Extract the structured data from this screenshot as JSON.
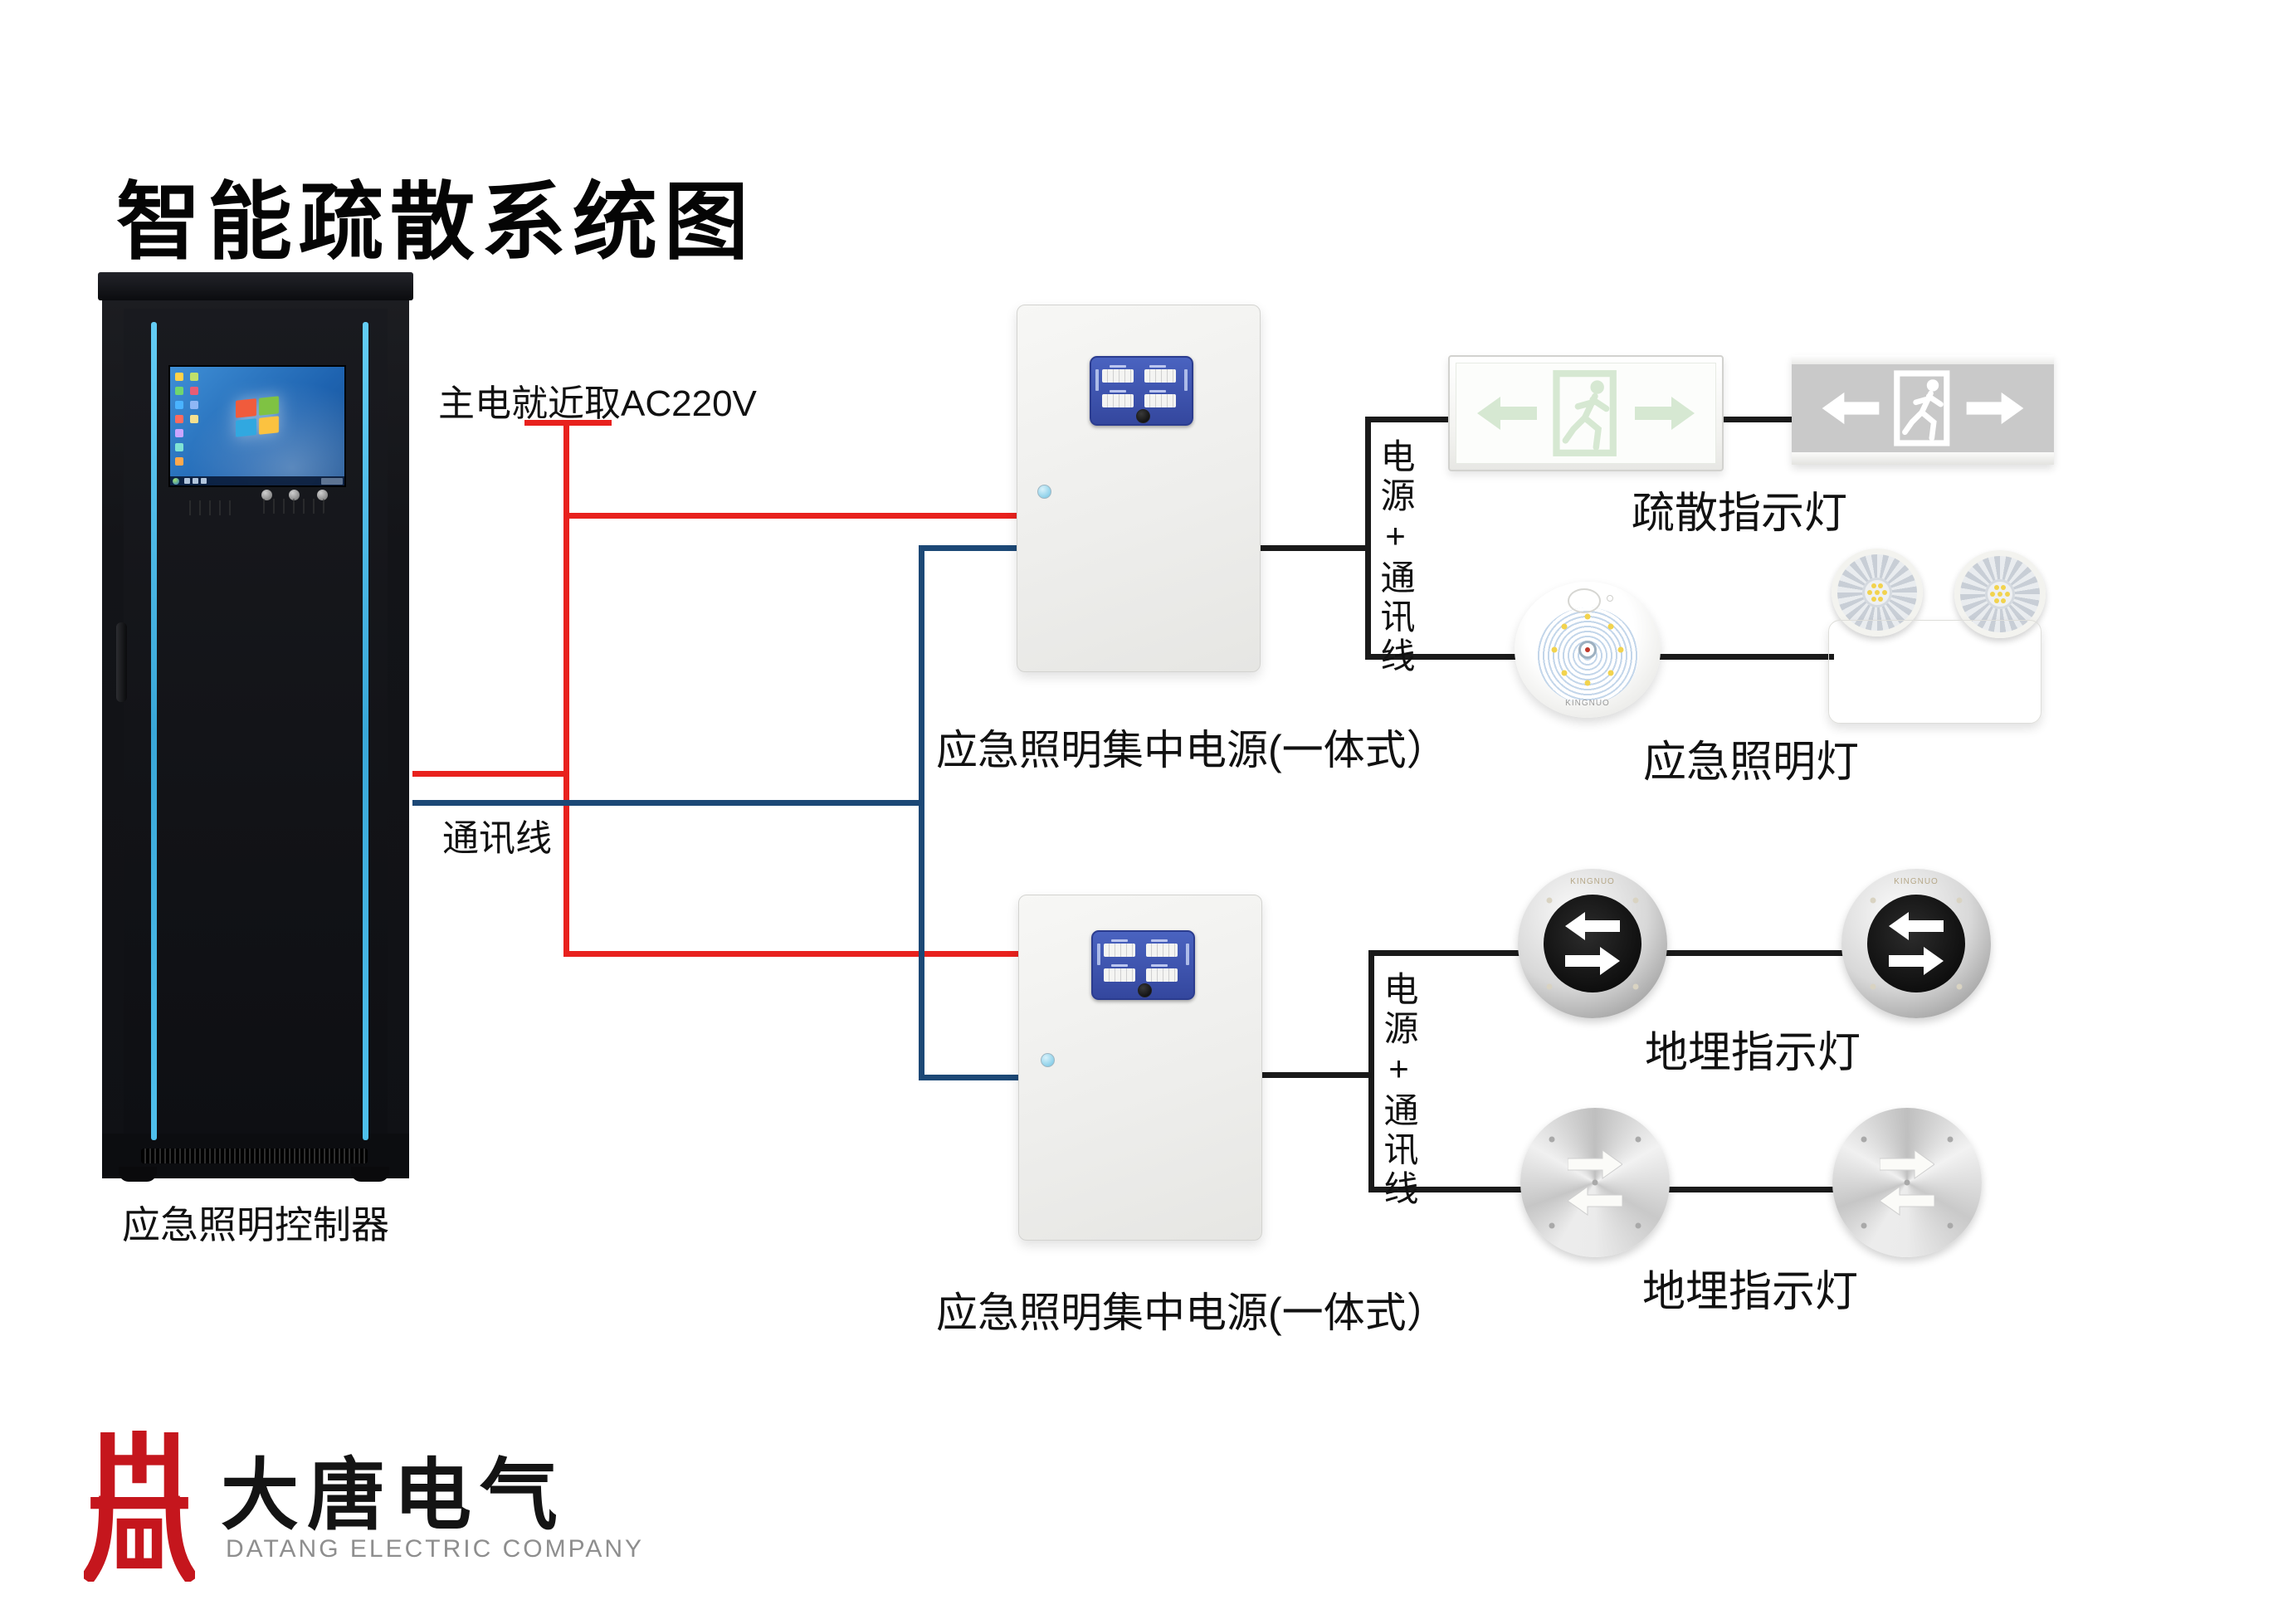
{
  "title": "智能疏散系统图",
  "colors": {
    "power_wire": "#e8211d",
    "comm_wire": "#1c4876",
    "device_wire": "#1a1a1a",
    "rack_accent": "#49b8ea",
    "panel_blue": "#3d55ad",
    "sign_green": "#d6e8d2",
    "sign_gray_panel": "#c9c9c9",
    "logo_red": "#c5161d",
    "logo_gray": "#8e8e8e"
  },
  "controller": {
    "label": "应急照明控制器"
  },
  "wires": {
    "mains_label": "主电就近取AC220V",
    "comm_label": "通讯线"
  },
  "junctions": [
    {
      "label": "电源+通讯线"
    },
    {
      "label": "电源+通讯线"
    }
  ],
  "power_boxes": [
    {
      "label": "应急照明集中电源(一体式）"
    },
    {
      "label": "应急照明集中电源(一体式）"
    }
  ],
  "device_labels": {
    "exit_signs": "疏散指示灯",
    "emergency_lights": "应急照明灯",
    "buried_lights_top": "地埋指示灯",
    "buried_lights_bottom": "地埋指示灯"
  },
  "brand": {
    "name": "KINGNUO"
  },
  "logo": {
    "cn": "大唐电气",
    "en": "DATANG ELECTRIC COMPANY"
  }
}
